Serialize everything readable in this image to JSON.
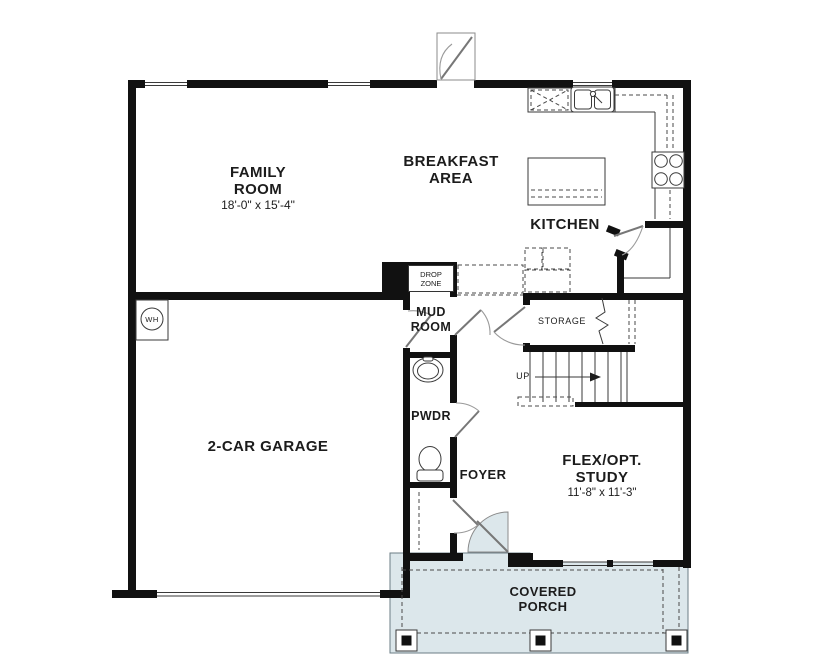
{
  "plan": {
    "title": "First floor plan",
    "rooms": {
      "family_room": {
        "line1": "FAMILY",
        "line2": "ROOM",
        "dims": "18'-0\" x 15'-4\""
      },
      "breakfast_area": {
        "line1": "BREAKFAST",
        "line2": "AREA"
      },
      "kitchen": {
        "label": "KITCHEN"
      },
      "garage": {
        "label": "2-CAR GARAGE"
      },
      "mud_room": {
        "line1": "MUD",
        "line2": "ROOM"
      },
      "drop_zone": {
        "line1": "DROP",
        "line2": "ZONE"
      },
      "pwdr": {
        "label": "PWDR"
      },
      "foyer": {
        "label": "FOYER"
      },
      "storage": {
        "label": "STORAGE"
      },
      "flex_study": {
        "line1": "FLEX/OPT.",
        "line2": "STUDY",
        "dims": "11'-8\" x 11'-3\""
      },
      "covered_porch": {
        "line1": "COVERED",
        "line2": "PORCH"
      },
      "stairs": {
        "label": "UP"
      },
      "water_heater": {
        "label": "WH"
      }
    },
    "colors": {
      "wall": "#111111",
      "porch": "#dce7eb",
      "line": "#3a3a3a"
    }
  }
}
